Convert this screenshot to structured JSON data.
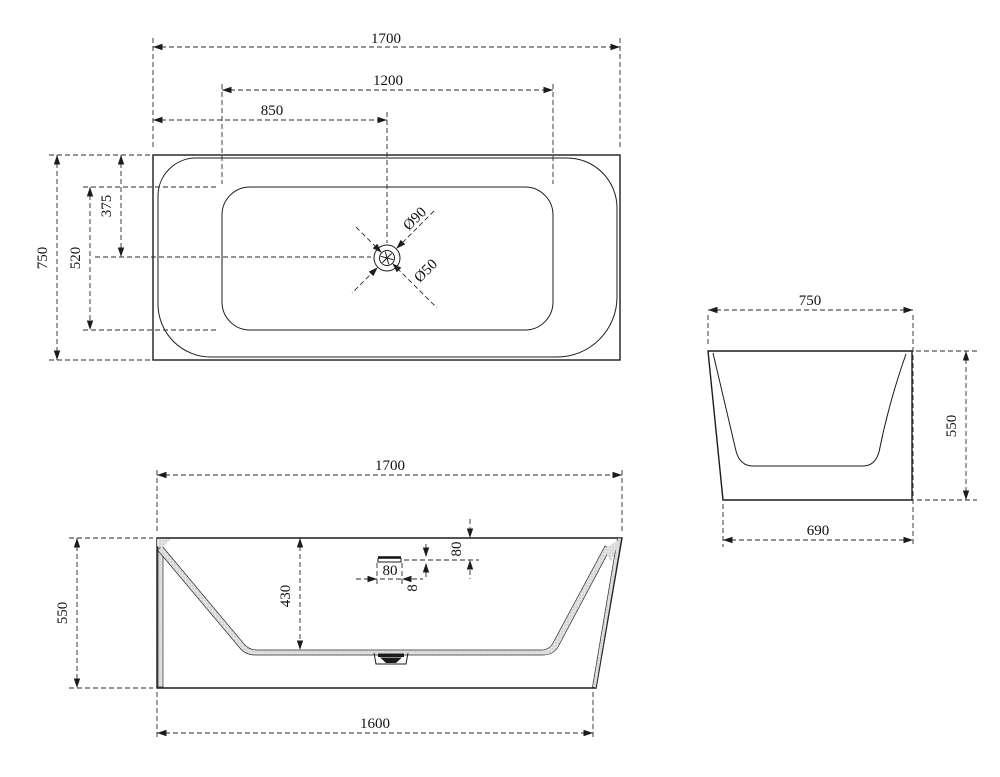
{
  "drawing_title": "bathtub-orthographic-dimension-drawing",
  "style": {
    "line_color": "#1c1c1c",
    "hatch_color": "#dcdcdc",
    "background": "#ffffff"
  },
  "views": {
    "top": {
      "length": "1700",
      "basin_length": "1200",
      "drain_offset": "850",
      "width": "750",
      "basin_width": "520",
      "drain_from_back": "375",
      "drain_outer": "Ø90",
      "drain_inner": "Ø50"
    },
    "front": {
      "length": "1700",
      "height": "550",
      "depth": "430",
      "overflow_width": "80",
      "overflow_slot": "8",
      "overflow_drop": "80",
      "base_length": "1600"
    },
    "side": {
      "width": "750",
      "height": "550",
      "base_width": "690"
    }
  }
}
